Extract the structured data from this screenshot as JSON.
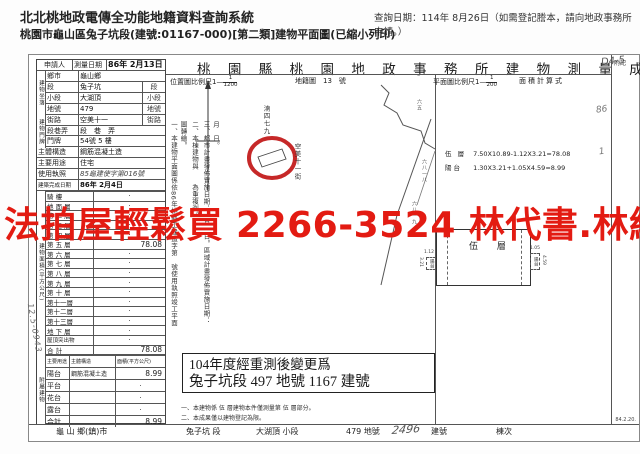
{
  "header": {
    "system_title": "北北桃地政電傳全功能地籍資料查詢系統",
    "query_date": "查詢日期：114年 8月26日（如需登記謄本，請向地政事務所申請。）",
    "subtitle": "桃園市龜山區兔子坑段(建號:01167-000)[第二類]建物平面圖(已縮小列印)"
  },
  "watermark": {
    "text": "法拍屋輕鬆買 2266-3524 林代書.林經理",
    "color": "#e31b12"
  },
  "doc": {
    "title": "桃 園 縣 桃 園 地 政 事 務 所 建 物 測 量 成 果 圖",
    "title_note": "D4-5",
    "scale": {
      "location_label": "位置圖比例尺1—",
      "location_num": "1",
      "location_den": "1200",
      "cadastral_label": "地籍圖",
      "cadastral_no": "13",
      "cadastral_unit": "號",
      "plan_label": "平面圖比例尺1—",
      "plan_num": "1",
      "plan_den": "200",
      "area_calc_label": "面積計算式",
      "right_col_label": "附記"
    },
    "table": {
      "applicant": "申請人",
      "group_site": "建物坐落",
      "group_door": "建物門牌",
      "rows_upper": [
        {
          "label": "測量日期",
          "value": "86年 2月13日",
          "suffix": ""
        },
        {
          "label": "鄉市",
          "value": "龜山鄉",
          "suffix": ""
        },
        {
          "label": "段",
          "value": "兔子坑",
          "suffix": "段"
        },
        {
          "label": "小段",
          "value": "大湖頂",
          "suffix": "小段"
        },
        {
          "label": "地號",
          "value": "479",
          "suffix": "地號"
        },
        {
          "label": "街路",
          "value": "空美十一",
          "suffix": "街路"
        },
        {
          "label": "段巷弄",
          "value": "段　巷　弄",
          "suffix": ""
        },
        {
          "label": "門牌",
          "value": "54號 5 樓",
          "suffix": ""
        },
        {
          "label": "主體構造",
          "value": "鋼筋混凝土造",
          "suffix": ""
        },
        {
          "label": "主要用途",
          "value": "住宅",
          "suffix": ""
        },
        {
          "label": "使用執照",
          "value": "85龜建使字第016號",
          "suffix": ""
        },
        {
          "label": "建築完成日期",
          "value": "86年 2月4日",
          "suffix": ""
        }
      ],
      "floors_group": "建物面積(平方公尺)",
      "floors": [
        {
          "label": "騎 樓",
          "value": "‧"
        },
        {
          "label": "地 面 層",
          "value": "‧"
        },
        {
          "label": "第 二 層",
          "value": "‧"
        },
        {
          "label": "第 三 層",
          "value": "‧"
        },
        {
          "label": "第 四 層",
          "value": "‧"
        },
        {
          "label": "第 五 層",
          "value": "78.08"
        },
        {
          "label": "第 六 層",
          "value": "‧"
        },
        {
          "label": "第 七 層",
          "value": "‧"
        },
        {
          "label": "第 八 層",
          "value": "‧"
        },
        {
          "label": "第 九 層",
          "value": "‧"
        },
        {
          "label": "第 十 層",
          "value": "‧"
        },
        {
          "label": "第十一層",
          "value": "‧"
        },
        {
          "label": "第十二層",
          "value": "‧"
        },
        {
          "label": "第十三層",
          "value": "‧"
        },
        {
          "label": "地 下 層",
          "value": "‧"
        },
        {
          "label": "屋頂突出物",
          "value": "‧"
        },
        {
          "label": "合 計",
          "value": "78.08"
        }
      ],
      "annex_group": "附屬建物",
      "annex_header": {
        "use": "主要用途",
        "structure": "主體構造",
        "area": "面積(平方公尺)"
      },
      "annex_rows": [
        {
          "use": "陽台",
          "structure": "鋼筋混凝土造",
          "area": "8.99"
        },
        {
          "use": "平台",
          "structure": "",
          "area": "‧"
        },
        {
          "use": "花台",
          "structure": "",
          "area": "‧"
        },
        {
          "use": "露台",
          "structure": "",
          "area": "‧"
        },
        {
          "use": "合計",
          "structure": "",
          "area": "8.99"
        }
      ],
      "stamp": "12.5-0943"
    },
    "map": {
      "street": "空美十一街",
      "parcel": "湳四七九",
      "road_label_1": "六五",
      "road_label_2": "六八一八",
      "road_label_3": "六八一九",
      "note_1": "一、本建物平面圖係依86年桃縣工建造字第　號使用執照竣工平面圖轉繪。",
      "note_2": "二、本棟建物與　　為重複測。",
      "note_3": "三、都市計畫發佈實施日期：　月　日。區域計畫發佈實施日期：　月　日。"
    },
    "plan": {
      "formula_1_name": "伍 層",
      "formula_1": "7.50X10.89-1.12X3.21=78.08",
      "formula_2_name": "陽台",
      "formula_2": "1.30X3.21+1.05X4.59=8.99",
      "main_label": "伍 層",
      "balcony_left": "陽台",
      "balcony_right": "陽台",
      "dim_left_w": "1.12",
      "dim_left_h": "3.21",
      "dim_right_w": "1.05",
      "dim_right_h": "4.59"
    },
    "remeasure_box": {
      "line1": "104年度經重測後變更爲",
      "line2": "兔子坑段 497 地號 1167 建號"
    },
    "bottom_notes": [
      "一、本建物係 伍 層建物本件僅測量第 伍 層部分。",
      "二、本成果僅以建物登記為限。"
    ],
    "footer": {
      "township": "龜 山 鄉(鎮)市",
      "section": "兔子坑 段",
      "subsection": "大湖頂 小段",
      "land_no": "479 地號",
      "building_no_hand": "2496",
      "building_no_label": "建號",
      "building_seq_label": "棟次",
      "form_version": "84.2.20."
    },
    "right_marks": {
      "mark1": "86",
      "mark2": "1"
    }
  }
}
